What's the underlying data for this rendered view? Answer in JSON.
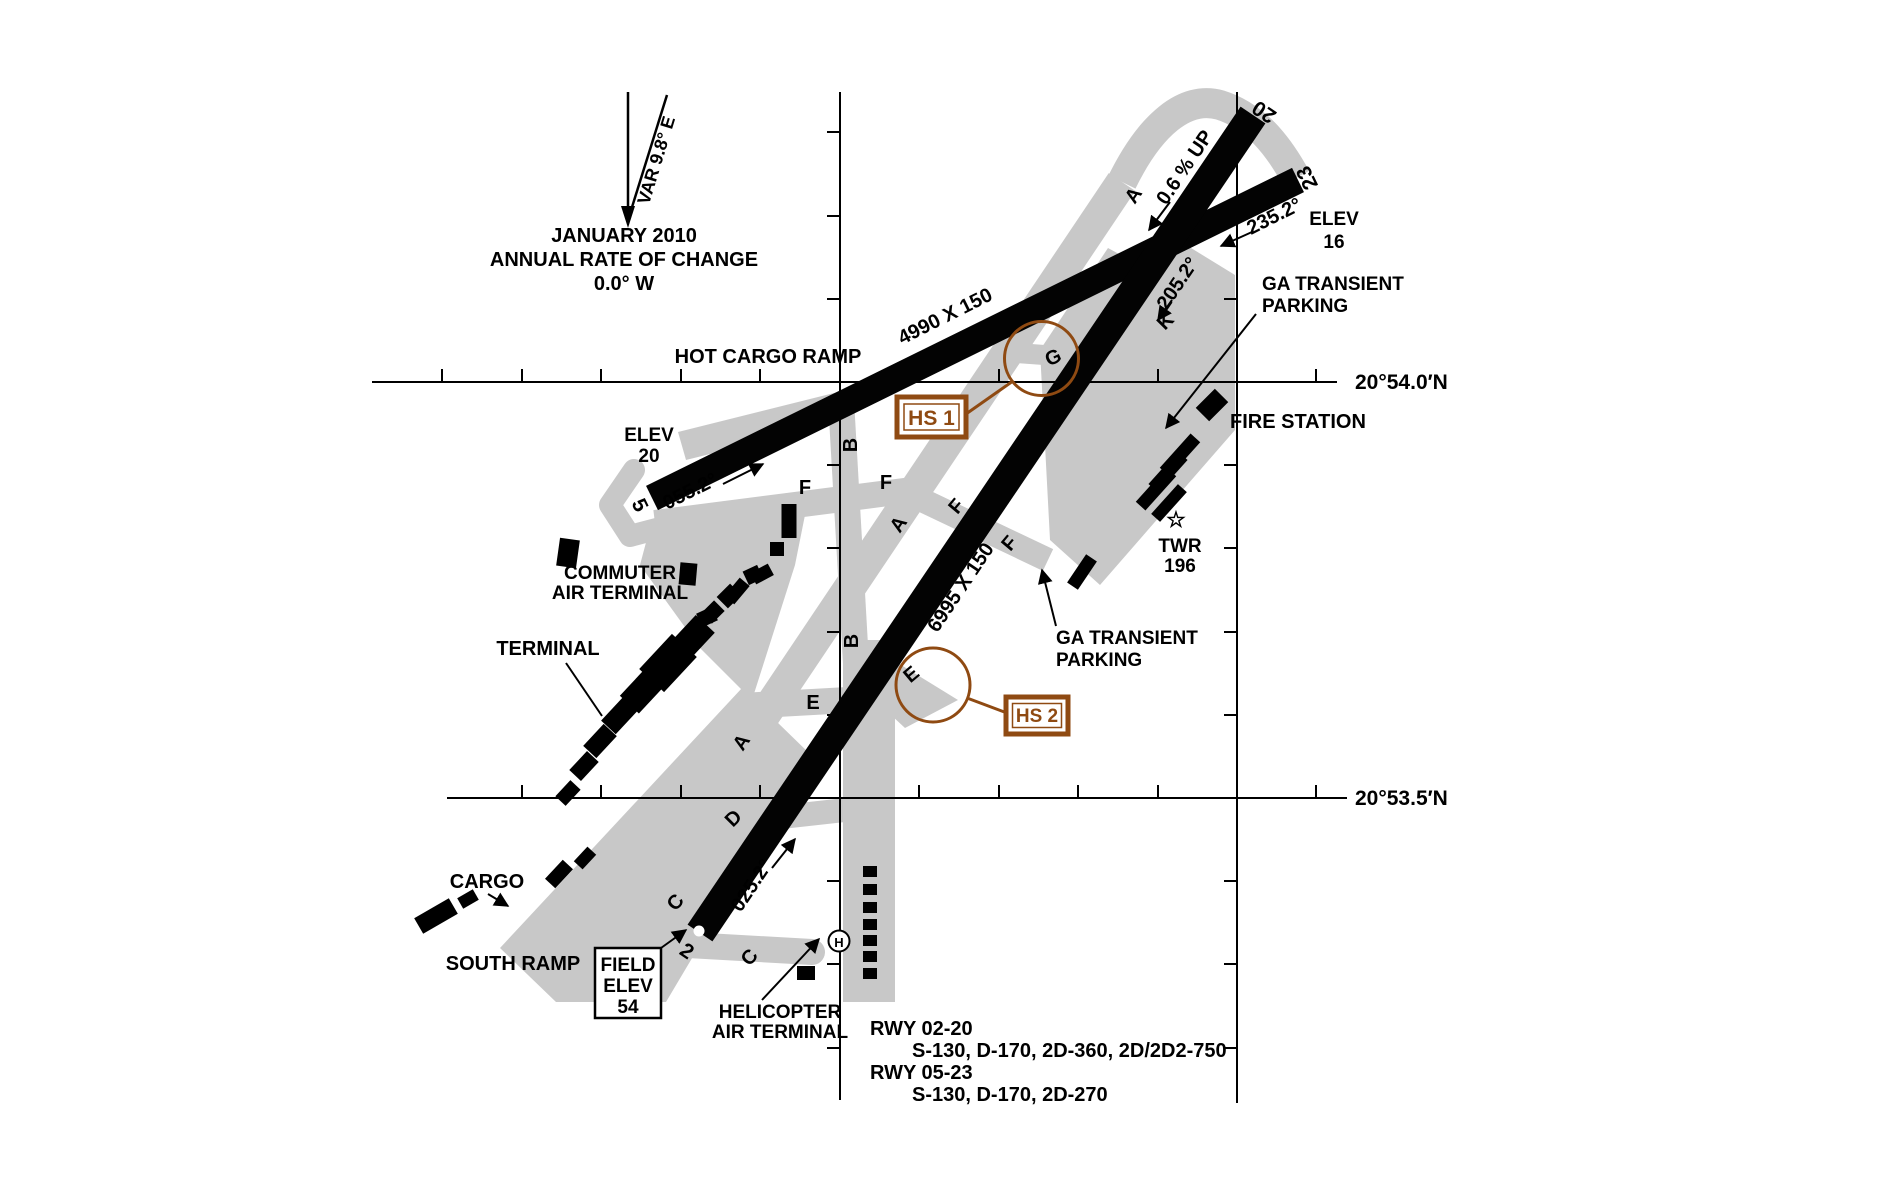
{
  "magnetic": {
    "var": "VAR 9.8° E",
    "date": "JANUARY 2010",
    "rate": "ANNUAL RATE OF CHANGE",
    "rate_value": "0.0°  W"
  },
  "graticule": {
    "lat_north": "20°54.0′N",
    "lat_south": "20°53.5′N"
  },
  "runway_05_23": {
    "dim": "4990 X 150",
    "hdg_05": "055.2°",
    "hdg_23": "235.2°",
    "num_05": "5",
    "num_23": "23",
    "elev_label": "ELEV",
    "elev_05": "20",
    "elev_23": "16"
  },
  "runway_02_20": {
    "dim": "6995 X 150",
    "hdg_02": "025.2°",
    "hdg_20": "205.2°",
    "num_02": "2",
    "num_20": "20",
    "gradient": "0.6 % UP"
  },
  "taxiways": {
    "a": "A",
    "b": "B",
    "c": "C",
    "d": "D",
    "e": "E",
    "f": "F",
    "g": "G",
    "k": "K"
  },
  "hotspots": {
    "hs1": "HS 1",
    "hs2": "HS 2"
  },
  "labels": {
    "hot_cargo_ramp": "HOT CARGO RAMP",
    "commuter_line1": "COMMUTER",
    "commuter_line2": "AIR TERMINAL",
    "terminal": "TERMINAL",
    "cargo": "CARGO",
    "south_ramp": "SOUTH RAMP",
    "helicopter_line1": "HELICOPTER",
    "helicopter_line2": "AIR TERMINAL",
    "fire_station": "FIRE STATION",
    "ga_transient_line1": "GA TRANSIENT",
    "ga_transient_line2": "PARKING",
    "twr": "TWR",
    "twr_elev": "196",
    "helipad": "H",
    "star": "☆"
  },
  "field_elevation": {
    "line1": "FIELD",
    "line2": "ELEV",
    "value": "54"
  },
  "declared_distances": {
    "rwy_02_20_title": "RWY 02-20",
    "rwy_02_20_data": "S-130, D-170, 2D-360, 2D/2D2-750",
    "rwy_05_23_title": "RWY 05-23",
    "rwy_05_23_data": "S-130, D-170, 2D-270"
  },
  "colors": {
    "pavement": "#c8c8c8",
    "ink": "#000000",
    "hotspot_brown": "#8f4a12",
    "background": "#ffffff"
  }
}
